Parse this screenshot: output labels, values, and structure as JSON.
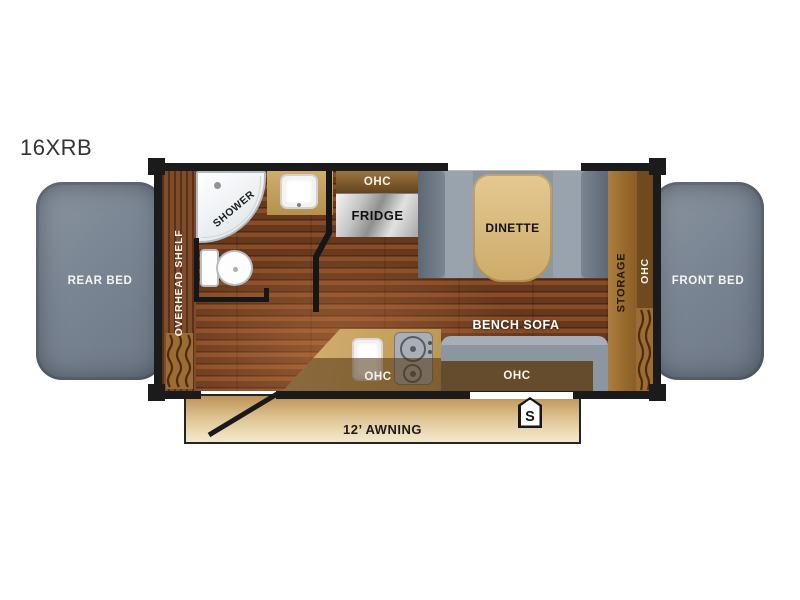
{
  "title": "16XRB",
  "beds": {
    "rear_label": "REAR BED",
    "front_label": "FRONT BED"
  },
  "left_side": {
    "overhead_shelf_label": "OVERHEAD SHELF"
  },
  "bathroom": {
    "shower_label": "SHOWER"
  },
  "kitchen": {
    "ohc_upper_label": "OHC",
    "fridge_label": "FRIDGE",
    "ohc_counter_label": "OHC"
  },
  "dinette": {
    "label": "DINETTE"
  },
  "right_side": {
    "storage_label": "STORAGE",
    "ohc_label": "OHC"
  },
  "sofa": {
    "label": "BENCH SOFA",
    "ohc_label": "OHC"
  },
  "exterior": {
    "awning_label": "12’ AWNING",
    "s_marker": "S"
  },
  "colors": {
    "bed_gray": "#7e8995",
    "wall_black": "#1b1b1b",
    "wood_floor": "#7a4424",
    "overhead_shelf_wood": "#744120",
    "storage_tan": "#a2743a",
    "ohc_dark_brown": "#6f4a1f",
    "counter_tan": "#c9a868",
    "sofa_gray": "#8e98a3",
    "dinette_table_tan": "#d8ba80",
    "awning_tan": "#e7d2a8",
    "fridge_silver": "#c6c6c6",
    "fixture_white": "#ffffff"
  }
}
